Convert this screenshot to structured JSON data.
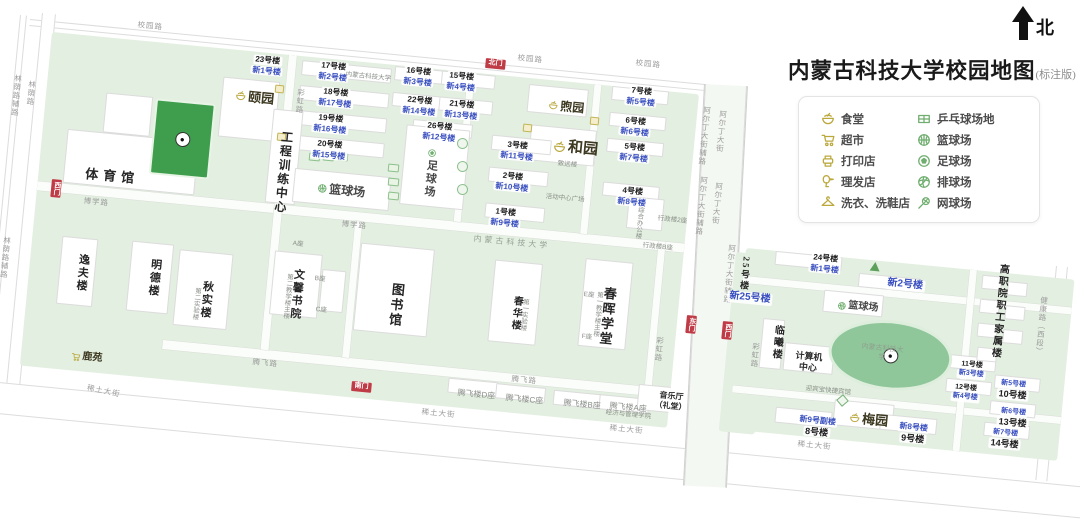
{
  "header": {
    "title": "内蒙古科技大学校园地图",
    "title_suffix": "(标注版)",
    "north_label": "北"
  },
  "legend": {
    "items_left": [
      {
        "icon": "canteen-icon",
        "label": "食堂"
      },
      {
        "icon": "supermarket-icon",
        "label": "超市"
      },
      {
        "icon": "print-shop-icon",
        "label": "打印店"
      },
      {
        "icon": "barber-icon",
        "label": "理发店"
      },
      {
        "icon": "laundry-icon",
        "label": "洗衣、洗鞋店"
      }
    ],
    "items_right": [
      {
        "icon": "pingpong-icon",
        "label": "乒乓球场地"
      },
      {
        "icon": "basketball-icon",
        "label": "篮球场"
      },
      {
        "icon": "football-icon",
        "label": "足球场"
      },
      {
        "icon": "volleyball-icon",
        "label": "排球场"
      },
      {
        "icon": "tennis-icon",
        "label": "网球场"
      }
    ],
    "accent_yellow": "#bba93e",
    "accent_green": "#6fae6f"
  },
  "map": {
    "colors": {
      "campus_green": "#e3efe0",
      "blue_label": "#3a50c0",
      "gate_red": "#bf3b46",
      "field_green": "#3f9e4d"
    },
    "labels": [
      {
        "k": "road",
        "t": "校园路",
        "x": 138,
        "y": 20
      },
      {
        "k": "road",
        "t": "校园路",
        "x": 518,
        "y": 53
      },
      {
        "k": "road",
        "t": "校园路",
        "x": 636,
        "y": 58
      },
      {
        "k": "road-v",
        "t": "林荫路辅路",
        "x": 14,
        "y": 74
      },
      {
        "k": "road-v",
        "t": "林荫路",
        "x": 28,
        "y": 80
      },
      {
        "k": "road-v",
        "t": "林荫路辅路",
        "x": 3,
        "y": 236
      },
      {
        "k": "road",
        "t": "博学路",
        "x": 84,
        "y": 196
      },
      {
        "k": "road",
        "t": "博学路",
        "x": 342,
        "y": 219
      },
      {
        "k": "road-v",
        "t": "彩虹路",
        "x": 297,
        "y": 88
      },
      {
        "k": "road-v",
        "t": "彩虹路",
        "x": 656,
        "y": 336
      },
      {
        "k": "road-v",
        "t": "彩虹路",
        "x": 752,
        "y": 342
      },
      {
        "k": "road",
        "t": "腾飞路",
        "x": 253,
        "y": 357
      },
      {
        "k": "road",
        "t": "腾飞路",
        "x": 512,
        "y": 374
      },
      {
        "k": "road",
        "t": "稀土大街",
        "x": 88,
        "y": 383,
        "r": 6
      },
      {
        "k": "road",
        "t": "稀土大街",
        "x": 422,
        "y": 407
      },
      {
        "k": "road",
        "t": "稀土大街",
        "x": 610,
        "y": 423
      },
      {
        "k": "road",
        "t": "稀土大街",
        "x": 798,
        "y": 439
      },
      {
        "k": "road-v",
        "t": "阿尔丁大街辅路",
        "x": 703,
        "y": 106
      },
      {
        "k": "road-v",
        "t": "阿尔丁大街",
        "x": 719,
        "y": 110
      },
      {
        "k": "road-v",
        "t": "阿尔丁大街辅路",
        "x": 700,
        "y": 176
      },
      {
        "k": "road-v",
        "t": "阿尔丁大街",
        "x": 715,
        "y": 182
      },
      {
        "k": "road-v",
        "t": "阿尔丁大街辅路",
        "x": 728,
        "y": 244
      },
      {
        "k": "road-v",
        "t": "健康路（西段）",
        "x": 1040,
        "y": 296
      },
      {
        "k": "gate",
        "t": "北门",
        "x": 486,
        "y": 58
      },
      {
        "k": "gate-v",
        "t": "西门",
        "x": 52,
        "y": 179
      },
      {
        "k": "gate",
        "t": "南门",
        "x": 352,
        "y": 381
      },
      {
        "k": "gate-v",
        "t": "东门",
        "x": 687,
        "y": 315
      },
      {
        "k": "gate-v",
        "t": "西门",
        "x": 723,
        "y": 321
      },
      {
        "k": "dorm",
        "t": "23号楼",
        "t2": "新1号楼",
        "x": 252,
        "y": 54
      },
      {
        "k": "dorm",
        "t": "17号楼",
        "t2": "新2号楼",
        "x": 318,
        "y": 60
      },
      {
        "k": "dorm",
        "t": "18号楼",
        "t2": "新17号楼",
        "x": 318,
        "y": 86
      },
      {
        "k": "dorm",
        "t": "19号楼",
        "t2": "新16号楼",
        "x": 313,
        "y": 112
      },
      {
        "k": "dorm",
        "t": "20号楼",
        "t2": "新15号楼",
        "x": 312,
        "y": 138
      },
      {
        "k": "dorm",
        "t": "16号楼",
        "t2": "新3号楼",
        "x": 403,
        "y": 65
      },
      {
        "k": "dorm",
        "t": "15号楼",
        "t2": "新4号楼",
        "x": 446,
        "y": 70
      },
      {
        "k": "dorm",
        "t": "22号楼",
        "t2": "新14号楼",
        "x": 402,
        "y": 94
      },
      {
        "k": "dorm",
        "t": "21号楼",
        "t2": "新13号楼",
        "x": 444,
        "y": 98
      },
      {
        "k": "dorm",
        "t": "26号楼",
        "t2": "新12号楼",
        "x": 422,
        "y": 120
      },
      {
        "k": "dorm",
        "t": "7号楼",
        "t2": "新5号楼",
        "x": 626,
        "y": 85
      },
      {
        "k": "dorm",
        "t": "6号楼",
        "t2": "新6号楼",
        "x": 620,
        "y": 115
      },
      {
        "k": "dorm",
        "t": "5号楼",
        "t2": "新7号楼",
        "x": 619,
        "y": 141
      },
      {
        "k": "dorm",
        "t": "4号楼",
        "t2": "新8号楼",
        "x": 617,
        "y": 185
      },
      {
        "k": "dorm",
        "t": "3号楼",
        "t2": "新11号楼",
        "x": 500,
        "y": 139
      },
      {
        "k": "dorm",
        "t": "2号楼",
        "t2": "新10号楼",
        "x": 495,
        "y": 170
      },
      {
        "k": "dorm",
        "t": "1号楼",
        "t2": "新9号楼",
        "x": 490,
        "y": 206
      },
      {
        "k": "name",
        "t": "体育馆",
        "x": 86,
        "y": 166,
        "s": 13,
        "ls": 5
      },
      {
        "k": "name-v",
        "t": "工程训练中心",
        "x": 280,
        "y": 130,
        "s": 12
      },
      {
        "k": "sport",
        "t": "篮球场",
        "x": 318,
        "y": 181,
        "s": 12,
        "icon": "basketball-icon"
      },
      {
        "k": "sport-v",
        "t": "足球场",
        "x": 426,
        "y": 148,
        "s": 11,
        "icon": "football-icon"
      },
      {
        "k": "sport",
        "t": "篮球场",
        "x": 838,
        "y": 299,
        "s": 10,
        "icon": "basketball-icon"
      },
      {
        "k": "name-v",
        "t": "逸夫楼",
        "x": 77,
        "y": 253,
        "s": 11
      },
      {
        "k": "name-v",
        "t": "明德楼",
        "x": 149,
        "y": 258,
        "s": 11
      },
      {
        "k": "name-v",
        "t": "秋实楼",
        "x": 201,
        "y": 280,
        "s": 11
      },
      {
        "k": "note-v",
        "t": "第二实验楼",
        "x": 193,
        "y": 287
      },
      {
        "k": "name-v",
        "t": "文馨书院",
        "x": 292,
        "y": 268,
        "s": 11
      },
      {
        "k": "note-v",
        "t": "第二教学楼主楼",
        "x": 285,
        "y": 273
      },
      {
        "k": "note",
        "t": "A座",
        "x": 293,
        "y": 240
      },
      {
        "k": "note",
        "t": "B座",
        "x": 315,
        "y": 275
      },
      {
        "k": "note",
        "t": "C座",
        "x": 316,
        "y": 306
      },
      {
        "k": "name-v",
        "t": "图书馆",
        "x": 390,
        "y": 282,
        "s": 13
      },
      {
        "k": "name-v",
        "t": "春华楼",
        "x": 511,
        "y": 295,
        "s": 10
      },
      {
        "k": "note-v",
        "t": "第一实验楼",
        "x": 521,
        "y": 298
      },
      {
        "k": "name-v",
        "t": "春晖学堂",
        "x": 602,
        "y": 286,
        "s": 13
      },
      {
        "k": "note-v",
        "t": "第一教学楼主楼",
        "x": 595,
        "y": 291
      },
      {
        "k": "note",
        "t": "E座",
        "x": 584,
        "y": 291
      },
      {
        "k": "note",
        "t": "F座",
        "x": 582,
        "y": 333
      },
      {
        "k": "note",
        "t": "致远楼",
        "x": 558,
        "y": 160
      },
      {
        "k": "note",
        "t": "活动中心广场",
        "x": 546,
        "y": 193
      },
      {
        "k": "canteen",
        "t": "颐园",
        "x": 236,
        "y": 88,
        "s": 13,
        "icon": "canteen-icon"
      },
      {
        "k": "canteen",
        "t": "煦园",
        "x": 549,
        "y": 98,
        "s": 12,
        "icon": "canteen-icon"
      },
      {
        "k": "canteen",
        "t": "和园",
        "x": 554,
        "y": 137,
        "s": 15,
        "icon": "canteen-icon"
      },
      {
        "k": "canteen",
        "t": "梅园",
        "x": 850,
        "y": 410,
        "s": 13,
        "icon": "canteen-icon"
      },
      {
        "k": "shop",
        "t": "鹿苑",
        "x": 72,
        "y": 350,
        "s": 10,
        "icon": "supermarket-icon"
      },
      {
        "k": "stack",
        "t": "音乐厅",
        "t2": "（礼堂）",
        "x": 656,
        "y": 390,
        "s": 8
      },
      {
        "k": "stack",
        "t": "计算机",
        "t2": "中心",
        "x": 796,
        "y": 350,
        "s": 9
      },
      {
        "k": "note",
        "t": "腾飞楼D座",
        "x": 458,
        "y": 388,
        "s": 8
      },
      {
        "k": "note",
        "t": "腾飞楼C座",
        "x": 506,
        "y": 393,
        "s": 8
      },
      {
        "k": "note",
        "t": "腾飞楼B座",
        "x": 564,
        "y": 398,
        "s": 8
      },
      {
        "k": "note",
        "t": "腾飞楼A座",
        "x": 610,
        "y": 401,
        "s": 8
      },
      {
        "k": "note",
        "t": "经济与管理学院",
        "x": 606,
        "y": 409
      },
      {
        "k": "note-v",
        "t": "综合办公楼",
        "x": 636,
        "y": 206
      },
      {
        "k": "note",
        "t": "行政楼2座",
        "x": 658,
        "y": 215
      },
      {
        "k": "note",
        "t": "行政楼B座",
        "x": 643,
        "y": 242
      },
      {
        "k": "uni",
        "t": "内蒙古科技大学",
        "x": 474,
        "y": 234
      },
      {
        "k": "note",
        "t": "内蒙古科技大学",
        "x": 346,
        "y": 71
      },
      {
        "k": "uni-w",
        "t": "内蒙古科技大学",
        "x": 860,
        "y": 342,
        "w": 46
      },
      {
        "k": "name-v",
        "t": "临曦楼",
        "x": 772,
        "y": 324,
        "s": 10
      },
      {
        "k": "name-v",
        "t": "25号楼",
        "x": 741,
        "y": 256,
        "s": 9
      },
      {
        "k": "blue",
        "t": "新25号楼",
        "x": 728,
        "y": 290
      },
      {
        "k": "dorm",
        "t": "24号楼",
        "t2": "新1号楼",
        "x": 810,
        "y": 252
      },
      {
        "k": "blue",
        "t": "新2号楼",
        "x": 886,
        "y": 277
      },
      {
        "k": "note",
        "t": "迎宾宝快捷宾馆",
        "x": 806,
        "y": 385
      },
      {
        "k": "dorm2",
        "t": "新9号副楼",
        "t2": "8号楼",
        "x": 798,
        "y": 414
      },
      {
        "k": "dorm2",
        "t": "新8号楼",
        "t2": "9号楼",
        "x": 898,
        "y": 421
      },
      {
        "k": "dorm",
        "t": "11号楼",
        "t2": "新3号楼",
        "x": 958,
        "y": 360,
        "sm": 1
      },
      {
        "k": "dorm",
        "t": "12号楼",
        "t2": "新4号楼",
        "x": 952,
        "y": 383,
        "sm": 1
      },
      {
        "k": "dorm2",
        "t": "新5号楼",
        "t2": "10号楼",
        "x": 998,
        "y": 379,
        "sm": 1
      },
      {
        "k": "dorm2",
        "t": "新6号楼",
        "t2": "13号楼",
        "x": 998,
        "y": 407,
        "sm": 1
      },
      {
        "k": "dorm2",
        "t": "新7号楼",
        "t2": "14号楼",
        "x": 990,
        "y": 428,
        "sm": 1
      },
      {
        "k": "name-v",
        "t": "高职院职工家属楼",
        "x": 997,
        "y": 263,
        "s": 10
      }
    ],
    "facilities": [
      {
        "k": "fg",
        "x": 309,
        "y": 153
      },
      {
        "k": "fg",
        "x": 323,
        "y": 153
      },
      {
        "k": "fg",
        "x": 337,
        "y": 153
      },
      {
        "k": "fg",
        "x": 388,
        "y": 164
      },
      {
        "k": "fg",
        "x": 388,
        "y": 178
      },
      {
        "k": "fg",
        "x": 388,
        "y": 192
      },
      {
        "k": "fc",
        "x": 457,
        "y": 138
      },
      {
        "k": "fc",
        "x": 457,
        "y": 161
      },
      {
        "k": "fc",
        "x": 457,
        "y": 184
      },
      {
        "k": "fy",
        "x": 275,
        "y": 85
      },
      {
        "k": "fy",
        "x": 277,
        "y": 133
      },
      {
        "k": "fy",
        "x": 523,
        "y": 124
      },
      {
        "k": "fy",
        "x": 590,
        "y": 117
      },
      {
        "k": "ft",
        "x": 870,
        "y": 262
      },
      {
        "k": "fd",
        "x": 838,
        "y": 396
      }
    ]
  }
}
